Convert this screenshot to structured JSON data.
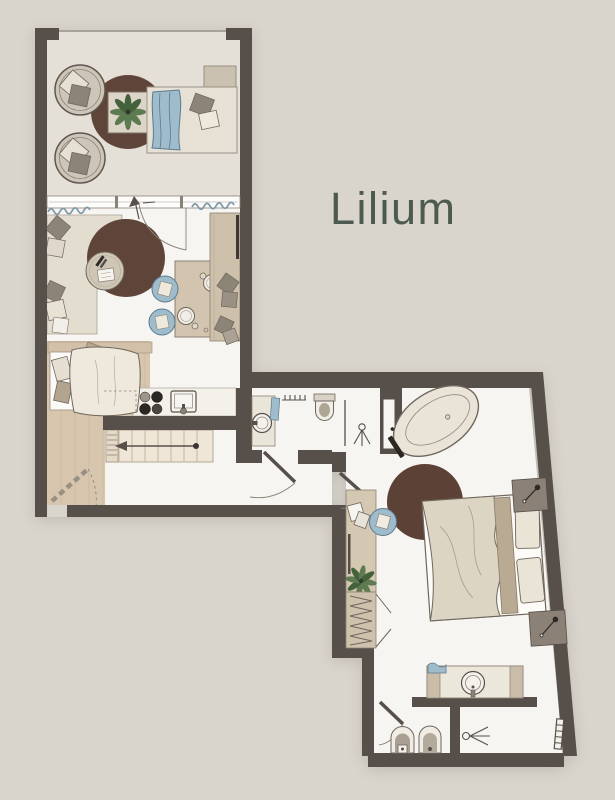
{
  "title": "Lilium",
  "palette": {
    "background": "#d9d5cd",
    "wall": "#57504a",
    "outline": "#6f675d",
    "floor": "#f7f5f1",
    "balcony_floor": "#e4e0d7",
    "wood_floor": "#d7c5ae",
    "wood_furniture": "#d2c3ac",
    "stairs": "#efe6d8",
    "counter": "#f4f1eb",
    "rug_brown": "#5f4539",
    "sofa": "#e3ddd0",
    "accent_blue": "#9fbccd",
    "accent_blue_dark": "#5b7a8c",
    "pillow_gray": "#8d8478",
    "pillow_cream": "#e9e3d6",
    "duvet": "#ddd5c4",
    "mattress": "#fcfbf8",
    "nightstand": "#8b8177",
    "leaf": "#5d7a50",
    "leaf_dark": "#45613c",
    "curtain": "#7e9aab",
    "title": "#4d5a50"
  },
  "furniture_icons": [
    "balcony-chair",
    "round-rug",
    "plant",
    "daybed",
    "side-table",
    "sofa",
    "coffee-table",
    "dining-table",
    "dining-chair",
    "tv-cabinet",
    "kitchen-stove",
    "kitchen-sink",
    "single-bed",
    "staircase",
    "direction-arrow",
    "folding-door",
    "door-swing",
    "bathroom-vanity",
    "towel",
    "radiator",
    "toilet",
    "shower",
    "glass-partition",
    "bathtub",
    "double-bed",
    "nightstand-lamp",
    "desk",
    "desk-chair",
    "wardrobe",
    "bidet",
    "towel-radiator"
  ]
}
